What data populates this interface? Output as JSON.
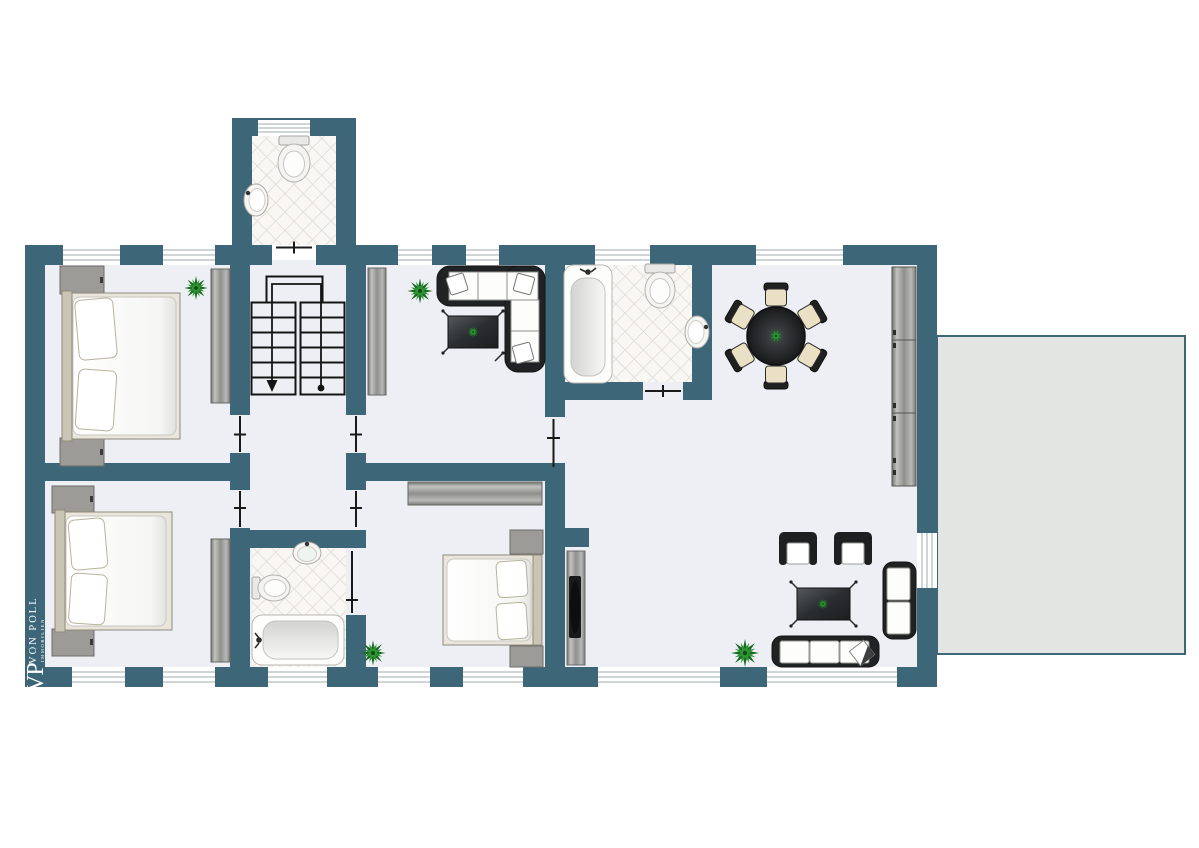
{
  "branding": {
    "logo_initials": "VP",
    "logo_name": "VON POLL",
    "logo_subtitle": "IMMOBILIEN"
  },
  "colors": {
    "wall": "#3d6678",
    "floor": "#edeff4",
    "terrace": "#e3e5e3",
    "tile": "#f8f7f4",
    "tileline": "#ddd9d3",
    "dark": "#202223",
    "gray": "#9b9b97",
    "cream": "#e9e0c6",
    "green": "#1f7a2d",
    "line": "#1a1a1a",
    "white": "#ffffff"
  },
  "floorplan": {
    "type": "apartment-floor-plan",
    "rooms": [
      {
        "name": "wc-annex",
        "label": "WC",
        "floor": "tiled",
        "fixtures": [
          "toilet",
          "washbasin"
        ]
      },
      {
        "name": "bedroom-top-left",
        "label": "Bedroom",
        "furniture": [
          "double bed",
          "two nightstands",
          "wardrobe",
          "plant"
        ]
      },
      {
        "name": "hallway",
        "label": "Hallway",
        "furniture": [
          "u-shaped staircase with down arrow"
        ]
      },
      {
        "name": "lounge",
        "label": "Lounge",
        "furniture": [
          "corner sofa",
          "coffee table",
          "wardrobe",
          "plant"
        ]
      },
      {
        "name": "bathroom-top",
        "label": "Bathroom",
        "floor": "tiled",
        "fixtures": [
          "bathtub",
          "toilet",
          "washbasin"
        ]
      },
      {
        "name": "living-dining",
        "label": "Living / Dining Room",
        "furniture": [
          "round dining table",
          "six dining chairs",
          "tall cabinet",
          "two armchairs",
          "coffee table",
          "two-seat sofa",
          "three-seat sofa",
          "tv sideboard",
          "two plants"
        ]
      },
      {
        "name": "bedroom-bottom-left",
        "label": "Bedroom",
        "furniture": [
          "double bed",
          "two nightstands",
          "wardrobe"
        ]
      },
      {
        "name": "bathroom-bottom",
        "label": "Bathroom",
        "floor": "tiled",
        "fixtures": [
          "bathtub",
          "toilet",
          "washbasin"
        ]
      },
      {
        "name": "bedroom-bottom-middle",
        "label": "Bedroom",
        "furniture": [
          "double bed",
          "two nightstands",
          "wardrobe",
          "plant"
        ]
      },
      {
        "name": "terrace",
        "label": "Terrace",
        "furniture": []
      }
    ],
    "windows": {
      "top_wall": 6,
      "bottom_wall": 7,
      "wc_annex": 1,
      "terrace_door": 1
    },
    "stairs": {
      "shape": "U-shaped, two flights",
      "direction_marker": "arrow down on left flight, start dot on right flight"
    }
  }
}
